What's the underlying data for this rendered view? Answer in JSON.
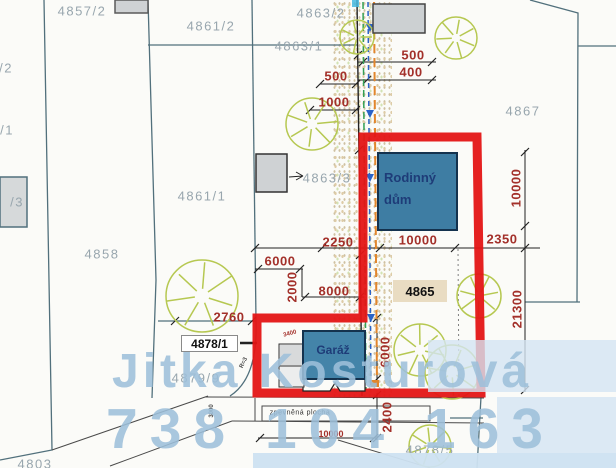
{
  "plan": {
    "house": {
      "line1": "Rodinný",
      "line2": "dům"
    },
    "garage": {
      "label": "Garáž"
    },
    "paved_area": {
      "label": "zpevněná plocha"
    },
    "parcel_boxes": {
      "plot": "4878/1",
      "parcel": "4865"
    },
    "watermark": {
      "name": "Jitka Kosturová",
      "phone": "738 104 163"
    },
    "colors": {
      "outline_red": "#e41515",
      "building_blue": "#3e7da3",
      "dimension_red": "#a3302a",
      "parcel_gray": "#98a6ae",
      "tree_green": "#b6c851",
      "watermark_blue": "#9dbfd9",
      "boundary_teal": "#51707c",
      "parcel_box_tan": "#e9dcc2"
    },
    "parcel_labels": [
      {
        "text": "4857/2",
        "x": 82,
        "y": 11
      },
      {
        "text": "4861/2",
        "x": 211,
        "y": 26
      },
      {
        "text": "4863/2",
        "x": 321,
        "y": 13
      },
      {
        "text": "4863/1",
        "x": 299,
        "y": 46
      },
      {
        "text": "4867",
        "x": 523,
        "y": 111
      },
      {
        "text": "4861/1",
        "x": 202,
        "y": 196
      },
      {
        "text": "4863/3",
        "x": 327,
        "y": 178
      },
      {
        "text": "4858",
        "x": 102,
        "y": 254
      },
      {
        "text": "4879/9",
        "x": 196,
        "y": 378
      },
      {
        "text": "4878/5",
        "x": 430,
        "y": 450
      },
      {
        "text": "4803",
        "x": 35,
        "y": 464
      },
      {
        "text": "/2",
        "x": 6,
        "y": 68
      },
      {
        "text": "/1",
        "x": 7,
        "y": 130
      },
      {
        "text": "/3",
        "x": 17,
        "y": 202
      }
    ],
    "dimension_labels": [
      {
        "text": "500",
        "x": 413,
        "y": 55
      },
      {
        "text": "400",
        "x": 411,
        "y": 72
      },
      {
        "text": "500",
        "x": 336,
        "y": 76
      },
      {
        "text": "1000",
        "x": 334,
        "y": 102
      },
      {
        "text": "2250",
        "x": 338,
        "y": 242
      },
      {
        "text": "10000",
        "x": 418,
        "y": 240
      },
      {
        "text": "2350",
        "x": 502,
        "y": 239
      },
      {
        "text": "10000",
        "x": 516,
        "y": 188,
        "rot": -90
      },
      {
        "text": "21300",
        "x": 517,
        "y": 309,
        "rot": -90
      },
      {
        "text": "6000",
        "x": 280,
        "y": 261
      },
      {
        "text": "2000",
        "x": 292,
        "y": 287,
        "rot": -90
      },
      {
        "text": "8000",
        "x": 334,
        "y": 291
      },
      {
        "text": "2760",
        "x": 229,
        "y": 317
      },
      {
        "text": "6000",
        "x": 385,
        "y": 352,
        "rot": -90
      },
      {
        "text": "2400",
        "x": 387,
        "y": 417,
        "rot": -90
      },
      {
        "text": "10000",
        "x": 331,
        "y": 434,
        "cls": "small"
      },
      {
        "text": "3400",
        "x": 290,
        "y": 334,
        "rot": -15,
        "cls": "tiny"
      },
      {
        "text": "3000",
        "x": 212,
        "y": 411,
        "rot": -90,
        "cls": "tiny dark"
      },
      {
        "text": "R=3",
        "x": 244,
        "y": 363,
        "rot": -65,
        "cls": "tiny dark"
      }
    ],
    "trees": [
      [
        357,
        37,
        17
      ],
      [
        456,
        38,
        21
      ],
      [
        312,
        124,
        26
      ],
      [
        202,
        296,
        36
      ],
      [
        479,
        296,
        22
      ],
      [
        420,
        350,
        26
      ],
      [
        452,
        372,
        27
      ],
      [
        430,
        446,
        21
      ]
    ]
  }
}
